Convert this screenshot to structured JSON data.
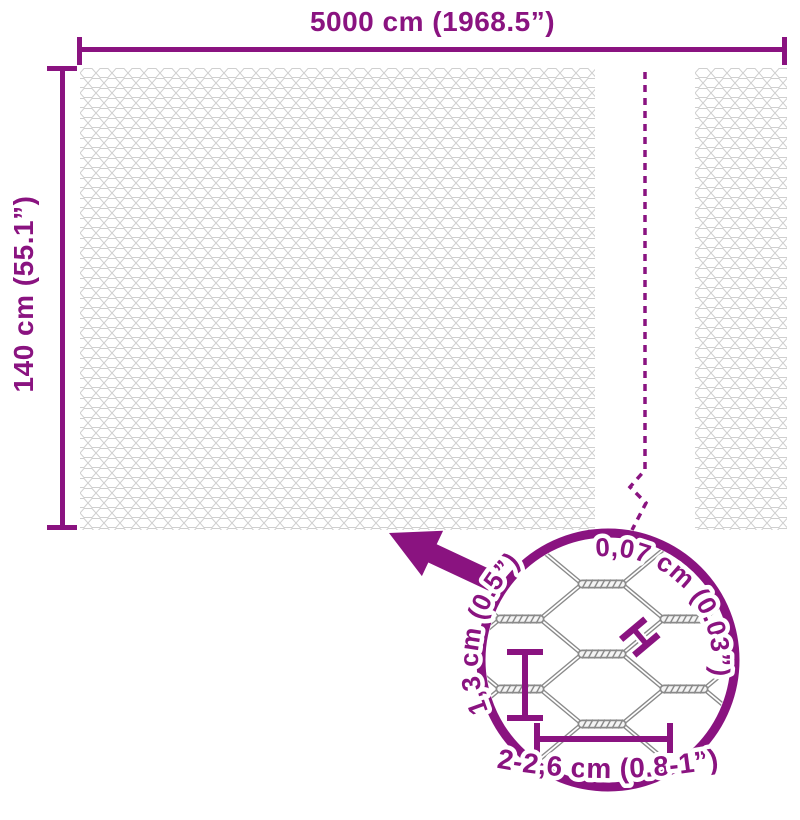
{
  "dimensions": {
    "width_label": "5000 cm (1968.5”)",
    "height_label": "140 cm (55.1”)"
  },
  "magnifier": {
    "wire_thickness_label": "0,07 cm (0.03”)",
    "wire_thickness_marker": "H",
    "cell_height_label": "1,3 cm (0.5”)",
    "cell_width_label": "2-2,6 cm (0.8-1”)"
  },
  "colors": {
    "accent_purple": "#8A1380",
    "mesh_texture_gray": "#cfcfcf",
    "detail_wire_gray": "#8a8a8a"
  }
}
